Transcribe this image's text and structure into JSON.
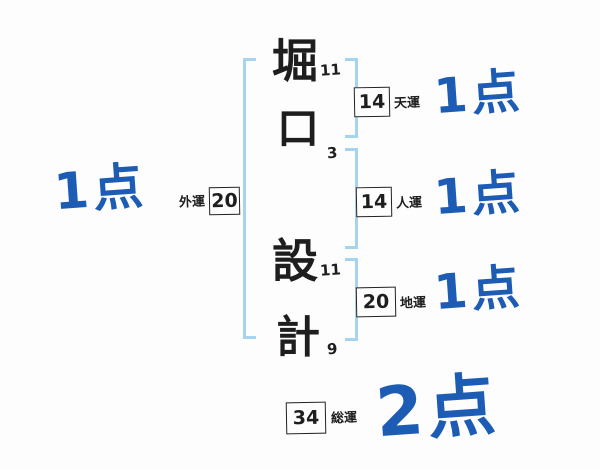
{
  "diagram_title": "name-stroke-fortune-diagram",
  "colors": {
    "score_blue": "#1c5cb4",
    "bracket_blue": "#a6d4ee",
    "ink_black": "#1e1e1e",
    "background": "#fdfdfd"
  },
  "name": {
    "characters": [
      {
        "glyph": "堀",
        "strokes": "11"
      },
      {
        "glyph": "口",
        "strokes": "3"
      },
      {
        "glyph": "設",
        "strokes": "11"
      },
      {
        "glyph": "計",
        "strokes": "9"
      }
    ]
  },
  "fortunes": {
    "outer": {
      "label": "外運",
      "value": "20",
      "score": "1点"
    },
    "heaven": {
      "label": "天運",
      "value": "14",
      "score": "1点"
    },
    "person": {
      "label": "人運",
      "value": "14",
      "score": "1点"
    },
    "earth": {
      "label": "地運",
      "value": "20",
      "score": "1点"
    },
    "total": {
      "label": "総運",
      "value": "34",
      "score": "2点"
    }
  }
}
